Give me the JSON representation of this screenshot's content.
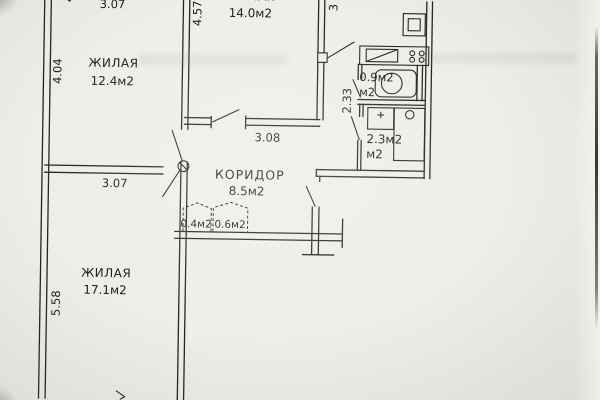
{
  "floor_plan": {
    "rooms": [
      {
        "id": "living-1",
        "name": "ЖИЛАЯ",
        "area": "12.4м2"
      },
      {
        "id": "living-2",
        "name": "ЖИЛАЯ",
        "area": "14.0м2"
      },
      {
        "id": "wc",
        "area": "0.9м2",
        "unit": "м2"
      },
      {
        "id": "bathroom",
        "area": "2.3м2",
        "unit": "м2"
      },
      {
        "id": "corridor",
        "name": "КОРИДОР",
        "area": "8.5м2"
      },
      {
        "id": "closet-1",
        "area": "0.4м2"
      },
      {
        "id": "closet-2",
        "area": "0.6м2"
      },
      {
        "id": "living-3",
        "name": "ЖИЛАЯ",
        "area": "17.1м2"
      }
    ],
    "dimensions": {
      "room1_width": "3.07",
      "room1_height": "4.04",
      "room2_height": "4.57",
      "right_top": "3",
      "sanitary_height": "2.33",
      "corridor_width": "3.08",
      "room3_width": "3.07",
      "room3_height": "5.58"
    },
    "colors": {
      "paper": "#efede8",
      "ink": "#232321"
    }
  }
}
